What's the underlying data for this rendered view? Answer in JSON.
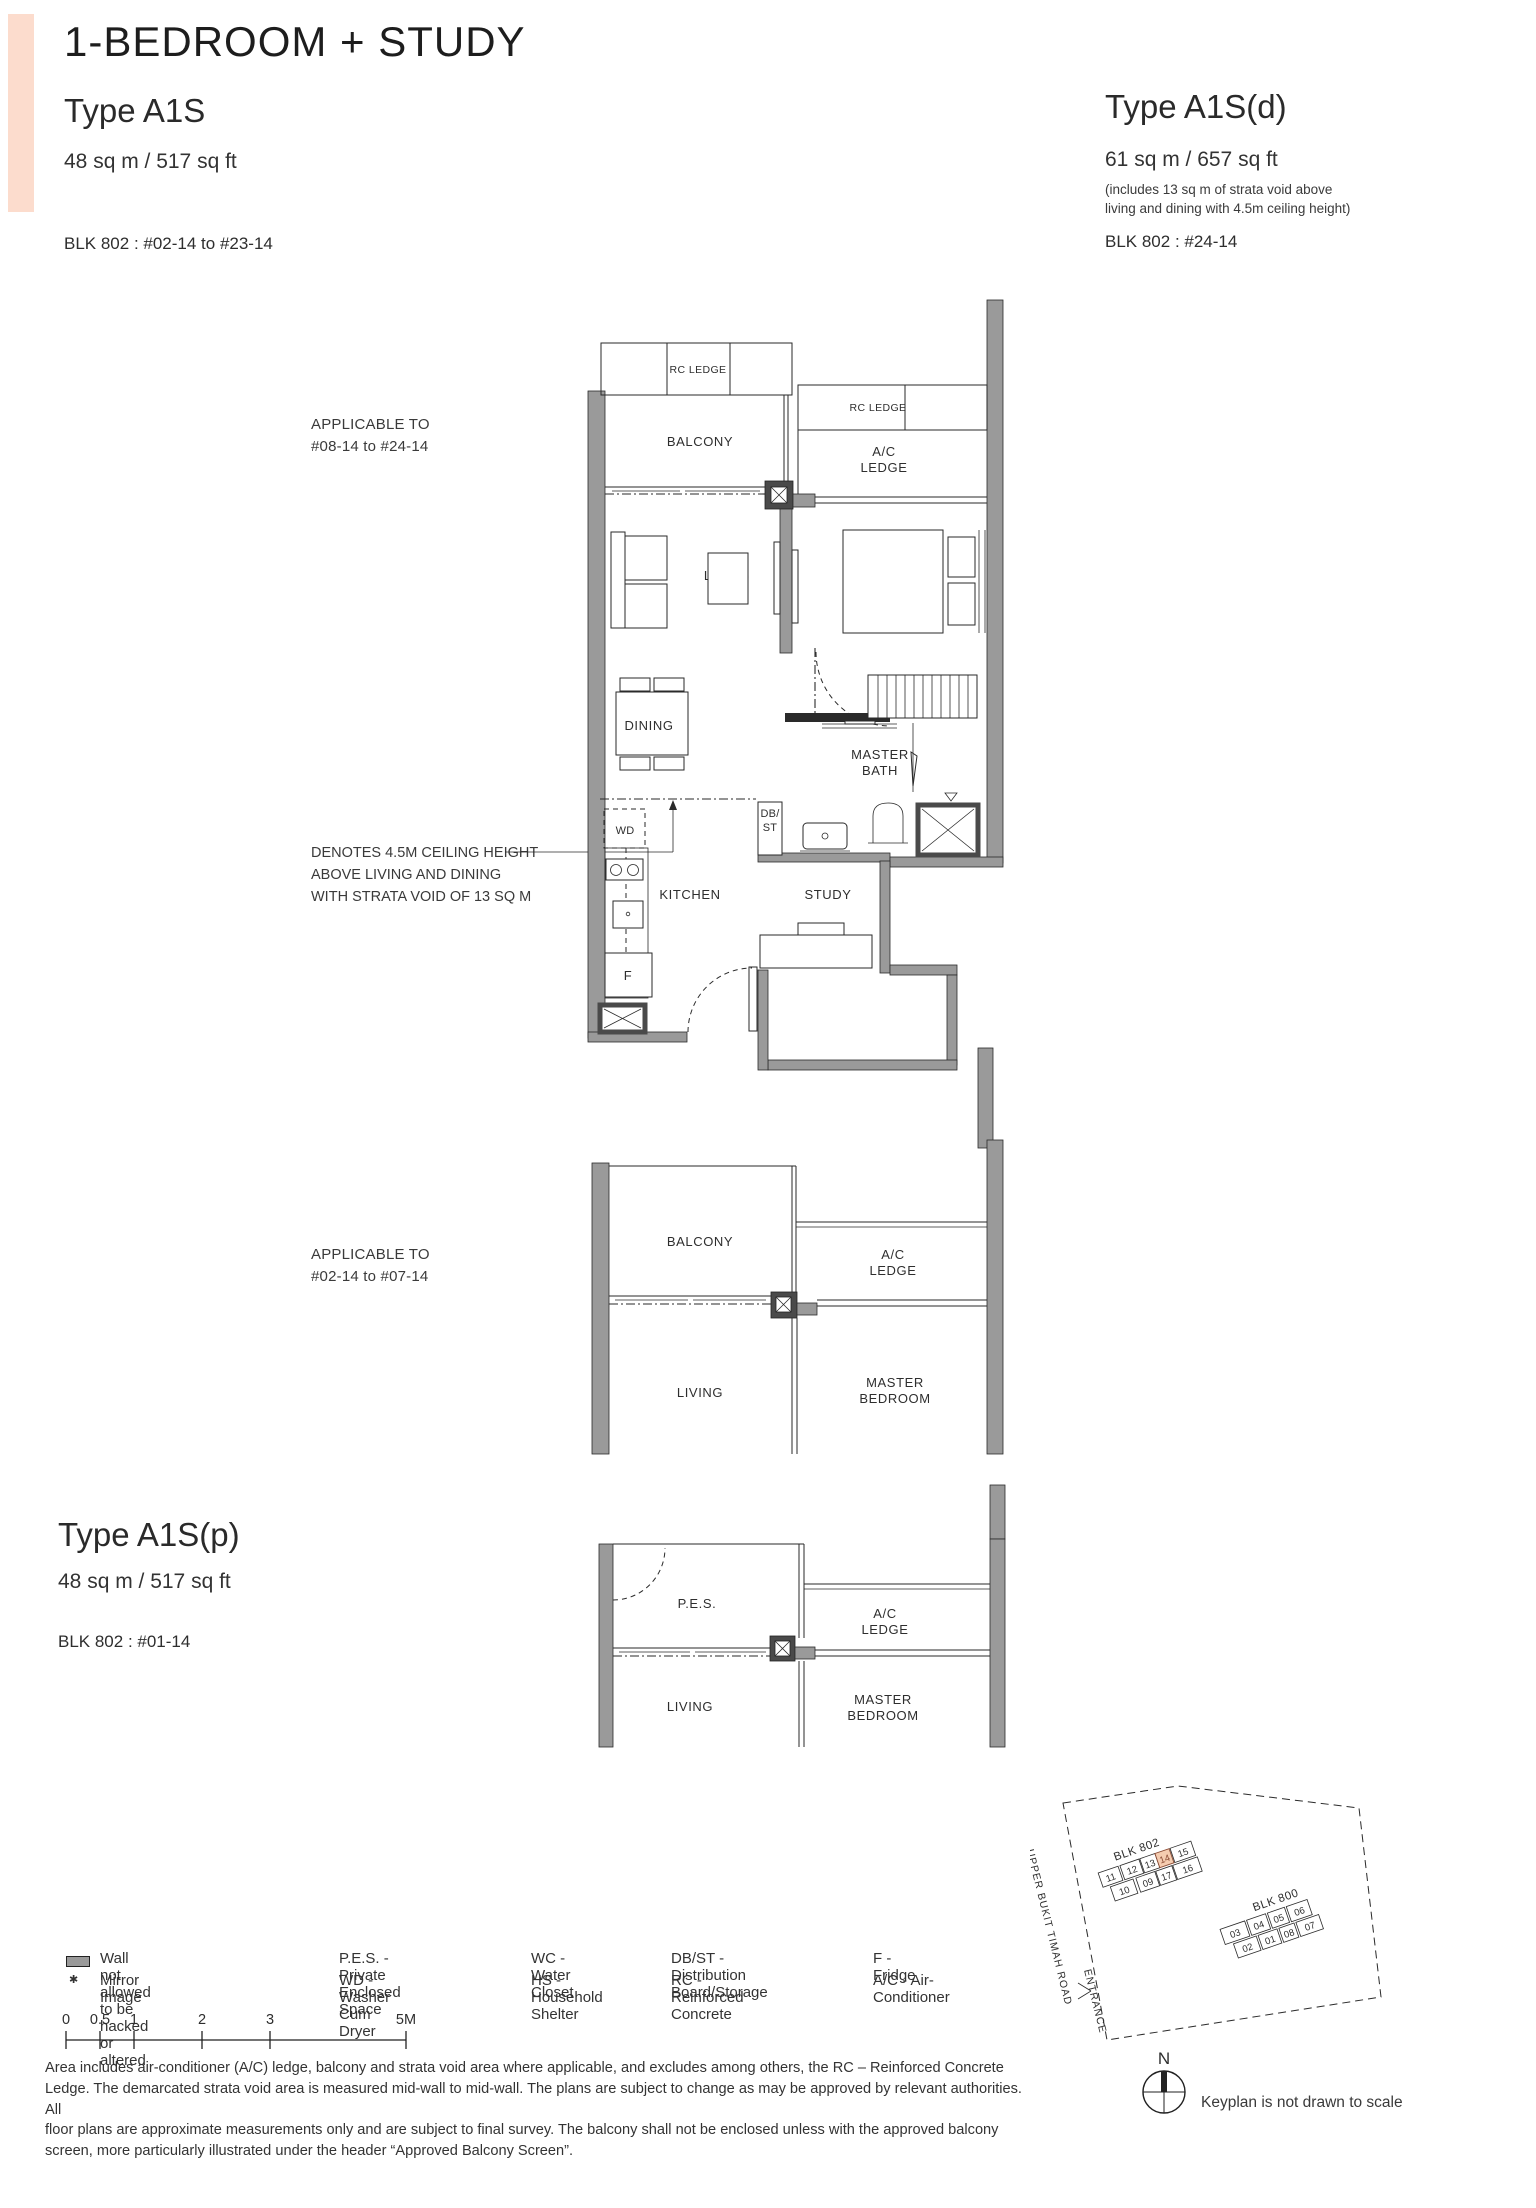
{
  "accent_color": "#fcdccd",
  "header": {
    "title": "1-BEDROOM + STUDY"
  },
  "types": {
    "a1s": {
      "name": "Type A1S",
      "area": "48 sq m / 517 sq ft",
      "blk": "BLK 802 : #02-14 to #23-14"
    },
    "a1sd": {
      "name": "Type A1S(d)",
      "area": "61 sq m / 657 sq ft",
      "note1": "(includes 13 sq m of strata void above",
      "note2": "living and dining with 4.5m ceiling height)",
      "blk": "BLK 802 : #24-14"
    },
    "a1sp": {
      "name": "Type A1S(p)",
      "area": "48 sq m / 517 sq ft",
      "blk": "BLK 802 : #01-14"
    }
  },
  "annotations": {
    "applicable_high_1": "APPLICABLE TO",
    "applicable_high_2": "#08-14 to #24-14",
    "applicable_low_1": "APPLICABLE TO",
    "applicable_low_2": "#02-14 to #07-14",
    "denotes_1": "DENOTES 4.5M CEILING HEIGHT",
    "denotes_2": "ABOVE LIVING AND DINING",
    "denotes_3": "WITH STRATA VOID OF 13 SQ M"
  },
  "plan_main": {
    "rc_ledge": "RC LEDGE",
    "rc_ledge_2": "RC LEDGE",
    "balcony": "BALCONY",
    "ac_1": "A/C",
    "ac_2": "LEDGE",
    "living": "LIVING",
    "master_1": "MASTER",
    "master_2": "BEDROOM",
    "dining": "DINING",
    "bath_1": "MASTER",
    "bath_2": "BATH",
    "wd": "WD",
    "dbst_1": "DB/",
    "dbst_2": "ST",
    "kitchen": "KITCHEN",
    "study": "STUDY",
    "fridge": "F"
  },
  "plan_mid": {
    "balcony": "BALCONY",
    "ac_1": "A/C",
    "ac_2": "LEDGE",
    "living": "LIVING",
    "master_1": "MASTER",
    "master_2": "BEDROOM"
  },
  "plan_pes": {
    "pes": "P.E.S.",
    "ac_1": "A/C",
    "ac_2": "LEDGE",
    "living": "LIVING",
    "master_1": "MASTER",
    "master_2": "BEDROOM"
  },
  "legend": {
    "wall": "Wall not allowed to be hacked or altered",
    "mirror_symbol": "✱",
    "mirror": "Mirror Image",
    "pes": "P.E.S. - Private Enclosed Space",
    "wd": "WD - Washer Cum Dryer",
    "wc": "WC - Water Closet",
    "hs": "HS - Household Shelter",
    "dbst": "DB/ST - Distribution Board/Storage",
    "rc": "RC - Reinforced Concrete",
    "f": "F - Fridge",
    "ac": "A/C - Air-Conditioner"
  },
  "scalebar": {
    "labels": [
      "0",
      "0.5",
      "1",
      "2",
      "3",
      "5M"
    ]
  },
  "disclaimer": [
    "Area includes air-conditioner (A/C) ledge, balcony and strata void area where applicable, and excludes among others, the RC – Reinforced Concrete",
    "Ledge. The demarcated strata void area is measured mid-wall to mid-wall. The plans are subject to change as may be approved by relevant authorities. All",
    "floor plans are approximate measurements only and are subject to final survey. The balcony shall not be enclosed unless with the approved balcony",
    "screen, more particularly illustrated under the header “Approved Balcony Screen”."
  ],
  "keyplan": {
    "highlight_color": "#f5ccb0",
    "blk802": {
      "label": "BLK 802",
      "units": [
        "11",
        "12",
        "13",
        "14",
        "15",
        "10",
        "09",
        "17",
        "16"
      ]
    },
    "blk800": {
      "label": "BLK 800",
      "units": [
        "03",
        "04",
        "05",
        "06",
        "02",
        "01",
        "08",
        "07"
      ]
    },
    "road": "UPPER BUKIT TIMAH ROAD",
    "entrance": "ENTRANCE",
    "north": "N",
    "note": "Keyplan is not drawn to scale"
  }
}
